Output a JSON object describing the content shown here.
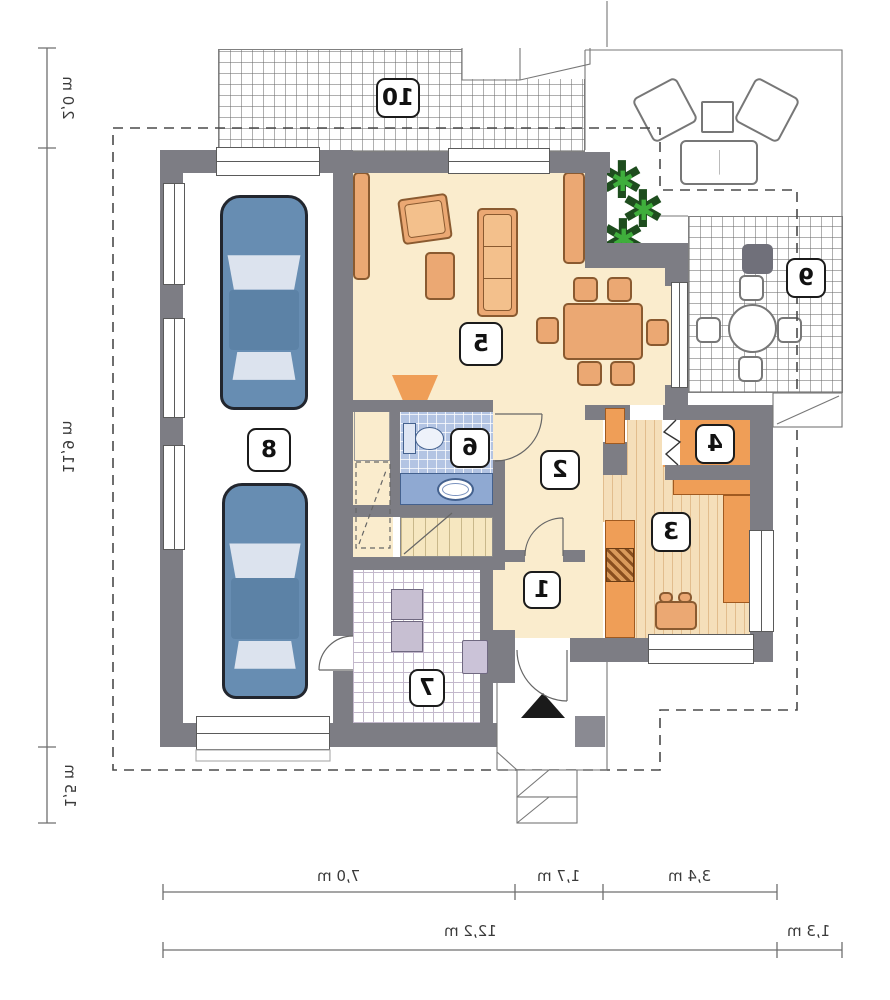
{
  "document": {
    "type": "house floor plan drawing",
    "orientation": "mirror image"
  },
  "room_labels": {
    "r1": "1",
    "r2": "2",
    "r3": "3",
    "r4": "4",
    "r5": "5",
    "r6": "6",
    "r7": "7",
    "r8": "8",
    "r9": "9",
    "r10": "10"
  },
  "dimensions": {
    "left": {
      "top": "2,0 m",
      "middle": "11,9 m",
      "bottom": "1,5 m"
    },
    "bottom_row1": {
      "seg1": "7,0 m",
      "seg2": "1,7 m",
      "seg3": "3,4 m"
    },
    "bottom_row2": {
      "seg1": "12,2 m",
      "seg2": "1,3 m"
    }
  },
  "icons": {
    "plant": "✱"
  },
  "colors": {
    "wall": "#7d7d84",
    "floor_cream": "#faeccd",
    "furniture_orange": "#eba873",
    "furniture_border": "#8a5a30",
    "counter_orange": "#ef9e57",
    "wood_floor": "#f5dfba",
    "wood_line": "#e2bd8d",
    "bath_blue": "#b3c4e3",
    "bath_counter": "#8fa9d2",
    "tile_line": "#c3b8cc",
    "stair_cream": "#f6e7c0",
    "car_blue": "#678db2",
    "car_glass": "#dce3ee",
    "plant_dark": "#1e4d1e",
    "plant_bright": "#3fae3c"
  }
}
